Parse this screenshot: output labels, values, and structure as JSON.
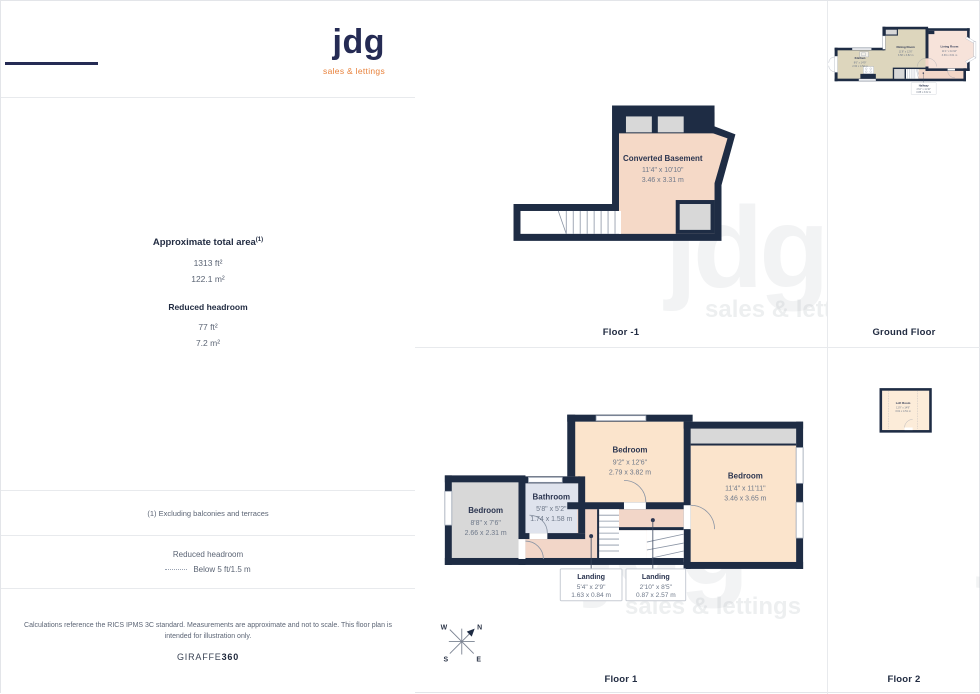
{
  "logo": {
    "name": "jdg",
    "tagline": "sales & lettings"
  },
  "watermark": {
    "word": "jdg",
    "tagline": "sales & lettings"
  },
  "compass": {
    "n": "N",
    "e": "E",
    "s": "S",
    "w": "W"
  },
  "panels": {
    "floor_minus1": {
      "label": "Floor -1",
      "rooms": {
        "basement": {
          "name": "Converted Basement",
          "ft": "11'4\" x 10'10\"",
          "m": "3.46 x 3.31 m"
        }
      }
    },
    "ground": {
      "label": "Ground Floor",
      "rooms": {
        "kitchen": {
          "name": "Kitchen",
          "ft": "8'6\" x 14'9\"",
          "m": "2.60 x 4.52 m"
        },
        "dining": {
          "name": "Dining Room",
          "ft": "11'8\" x 12'6\"",
          "m": "3.58 x 3.82 m"
        },
        "living": {
          "name": "Living Room",
          "ft": "11'1\" x 11'10\"",
          "m": "3.39 x 3.61 m"
        },
        "hallway": {
          "name": "Hallway",
          "ft": "2'10\" x 11'10\"",
          "m": "0.88 x 3.62 m"
        }
      }
    },
    "floor1": {
      "label": "Floor 1",
      "rooms": {
        "bedroom_mid": {
          "name": "Bedroom",
          "ft": "9'2\" x 12'6\"",
          "m": "2.79 x 3.82 m"
        },
        "bedroom_right": {
          "name": "Bedroom",
          "ft": "11'4\" x 11'11\"",
          "m": "3.46 x 3.65 m"
        },
        "bedroom_left": {
          "name": "Bedroom",
          "ft": "8'8\" x 7'6\"",
          "m": "2.66 x 2.31 m"
        },
        "bathroom": {
          "name": "Bathroom",
          "ft": "5'8\" x 5'2\"",
          "m": "1.74 x 1.58 m"
        },
        "landing1": {
          "name": "Landing",
          "ft": "5'4\" x 2'9\"",
          "m": "1.63 x 0.84 m"
        },
        "landing2": {
          "name": "Landing",
          "ft": "2'10\" x 8'5\"",
          "m": "0.87 x 2.57 m"
        }
      }
    },
    "floor2": {
      "label": "Floor 2",
      "rooms": {
        "loft": {
          "name": "Loft Room",
          "ft": "11'9\" x 14'9\"",
          "m": "3.61 x 4.51 m"
        }
      }
    }
  },
  "sidebar": {
    "area_heading": "Approximate total area",
    "area_sup": "(1)",
    "area_ft": "1313 ft²",
    "area_m": "122.1 m²",
    "headroom_heading": "Reduced headroom",
    "headroom_ft": "77 ft²",
    "headroom_m": "7.2 m²",
    "footnote": "(1) Excluding balconies and terraces",
    "legend_title": "Reduced headroom",
    "legend_value": "Below 5 ft/1.5 m",
    "disclaimer": "Calculations reference the RICS IPMS 3C standard. Measurements are approximate and not to scale. This floor plan is intended for illustration only.",
    "brand": "GIRAFFE",
    "brand_bold": "360"
  },
  "colors": {
    "wall": "#1e2c44",
    "tan": "#ddd6bd",
    "living_pink": "#f7e3da",
    "bedroom_peach": "#fbe4cc",
    "loft_cream": "#fcecd9",
    "basement_peach": "#f5d9c7",
    "hall_pink": "#f2d6c8",
    "bathroom_blue": "#dfe3ed",
    "gray": "#d8d8d8",
    "accent_orange": "#e8823c",
    "navy_text": "#222c42"
  }
}
